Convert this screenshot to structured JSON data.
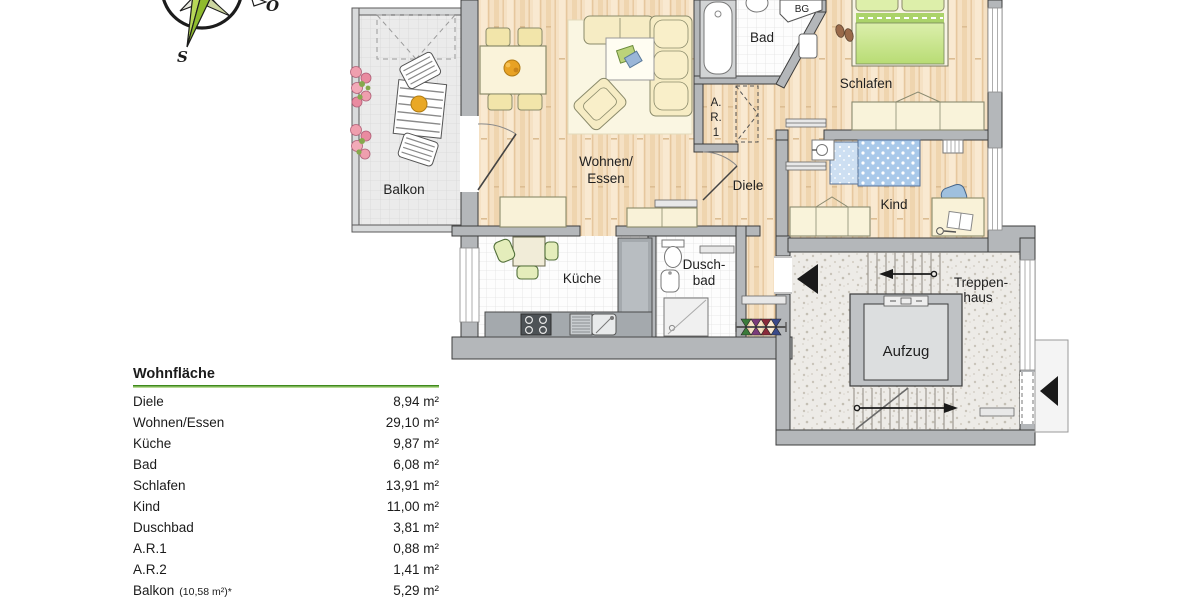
{
  "compass": {
    "south_label": "S",
    "east_label": "O"
  },
  "plan": {
    "labels": {
      "balkon": "Balkon",
      "wohnen_line1": "Wohnen/",
      "wohnen_line2": "Essen",
      "bad": "Bad",
      "bg": "BG",
      "schlafen": "Schlafen",
      "ar1_line1": "A.",
      "ar1_line2": "R.",
      "ar1_line3": "1",
      "diele": "Diele",
      "kind": "Kind",
      "kueche": "Küche",
      "duschbad_line1": "Dusch-",
      "duschbad_line2": "bad",
      "treppenhaus_line1": "Treppen-",
      "treppenhaus_line2": "haus",
      "aufzug": "Aufzug"
    }
  },
  "area_table": {
    "title": "Wohnfläche",
    "rows": [
      {
        "label": "Diele",
        "value": "8,94 m²"
      },
      {
        "label": "Wohnen/Essen",
        "value": "29,10 m²"
      },
      {
        "label": "Küche",
        "value": "9,87 m²"
      },
      {
        "label": "Bad",
        "value": "6,08 m²"
      },
      {
        "label": "Schlafen",
        "value": "13,91 m²"
      },
      {
        "label": "Kind",
        "value": "11,00 m²"
      },
      {
        "label": "Duschbad",
        "value": "3,81 m²"
      },
      {
        "label": "A.R.1",
        "value": "0,88 m²"
      },
      {
        "label": "A.R.2",
        "value": "1,41 m²"
      },
      {
        "label": "Balkon",
        "note": "(10,58 m²)*",
        "value": "5,29 m²"
      }
    ]
  },
  "colors": {
    "wall_gray": "#b4b7ba",
    "wood_floor": "#f5e1c4",
    "table_rule_green": "#3f8a1c",
    "compass_green": "#8fbb2e",
    "accent_black": "#1c1c1c"
  }
}
